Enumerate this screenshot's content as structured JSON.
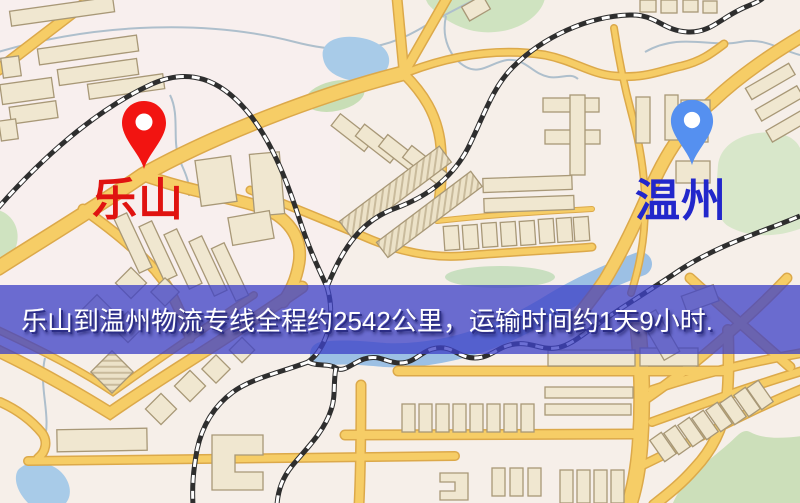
{
  "origin": {
    "label": "乐山"
  },
  "destination": {
    "label": "温州"
  },
  "banner": {
    "text": "乐山到温州物流专线全程约2542公里，运输时间约1天9小时.",
    "distance_text": "2542公里",
    "duration_text": "1天9小时"
  },
  "colors": {
    "origin_pin": "#f21411",
    "origin_label": "#e01310",
    "destination_pin": "#5590f0",
    "destination_label": "#2227cb",
    "banner_overlay": "#3e42c6",
    "banner_text": "#ffffff",
    "road_fill": "#f6cd66",
    "road_casing": "#dca94a",
    "water": "#a8cbe8",
    "park": "#cfe3c0",
    "railway": "#2e2e2e",
    "map_background": "#f6efe9",
    "building_fill": "#f0e7d0",
    "building_stroke": "#a89877"
  }
}
